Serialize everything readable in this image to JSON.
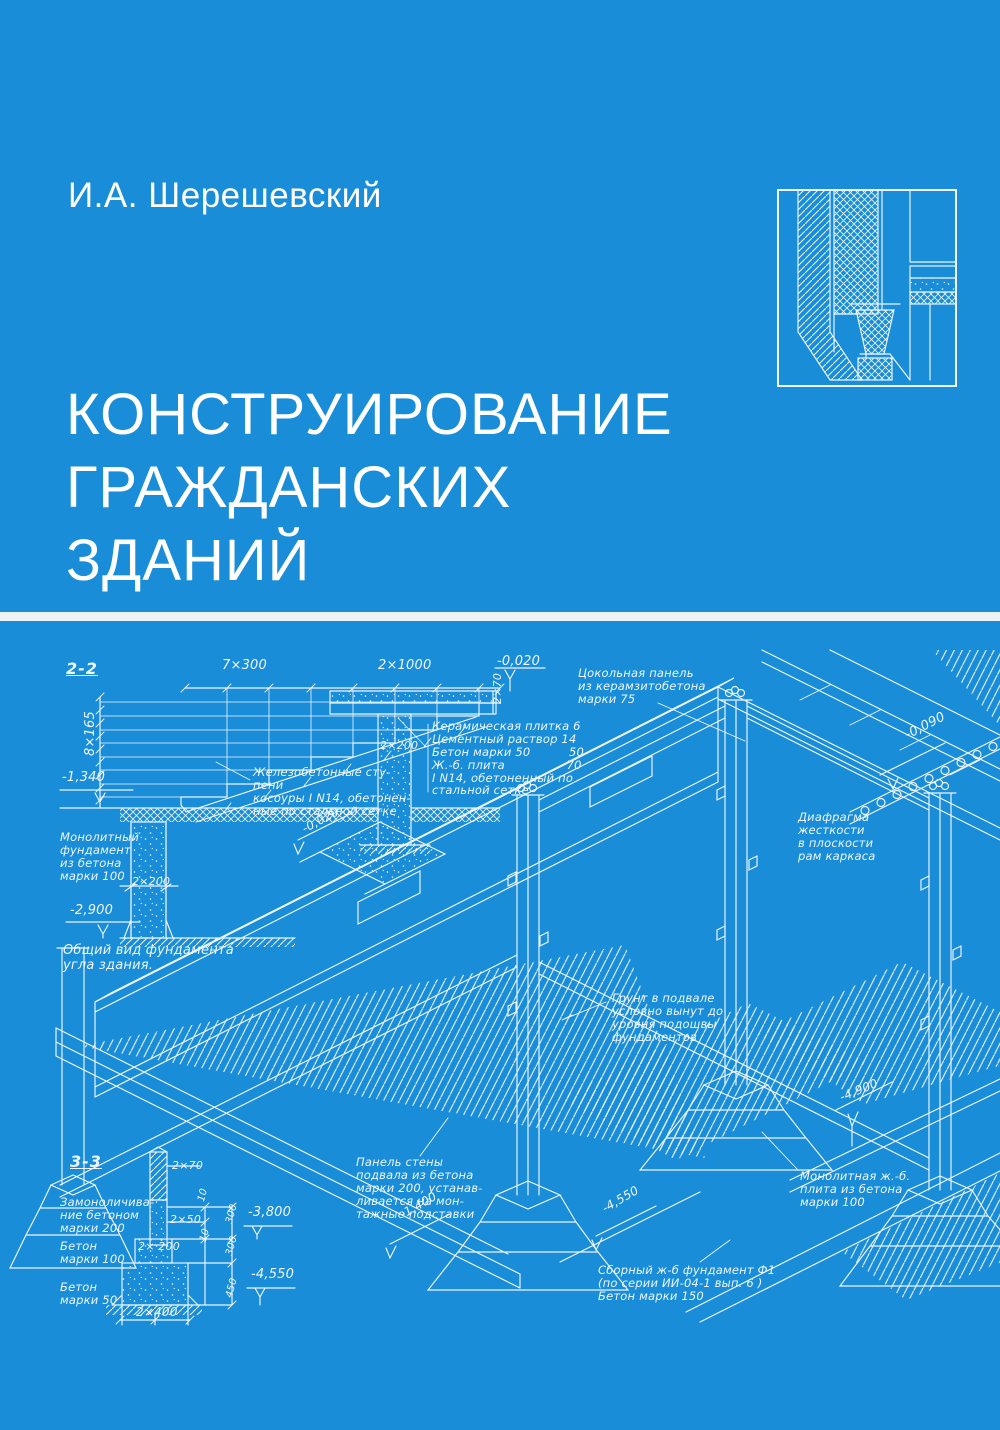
{
  "cover": {
    "author": "И.А. Шерешевский",
    "title_lines": [
      "КОНСТРУИРОВАНИЕ",
      "ГРАЖДАНСКИХ",
      "ЗДАНИЙ"
    ],
    "colors": {
      "background": "#1a8dd8",
      "ink": "#eef6fb",
      "title": "#ffffff",
      "divider": "#eef3f6"
    }
  },
  "drawing": {
    "labels": [
      {
        "text": "2-2",
        "x": 66,
        "y": 660,
        "size": 16,
        "u": true
      },
      {
        "text": "7×300",
        "x": 222,
        "y": 659,
        "size": 13
      },
      {
        "text": "2×1000",
        "x": 378,
        "y": 659,
        "size": 13
      },
      {
        "text": "-0,020",
        "x": 497,
        "y": 655,
        "size": 13
      },
      {
        "text": "8×165",
        "x": 84,
        "y": 756,
        "size": 13,
        "rot": -90
      },
      {
        "text": "2×70",
        "x": 492,
        "y": 704,
        "size": 11,
        "rot": -90
      },
      {
        "text": "2×200",
        "x": 380,
        "y": 740,
        "size": 11
      },
      {
        "text": "Керамическая плитка 6\nЦементный раствор 14\nБетон марки 50          50\nЖ.-б. плита                70\nI N14, обетоненный по\nстальной сетке",
        "x": 432,
        "y": 720,
        "size": 11.5
      },
      {
        "text": "Цокольная панель\nиз керамзитобетона\nмарки 75",
        "x": 578,
        "y": 667,
        "size": 11.5
      },
      {
        "text": "-0,090",
        "x": 903,
        "y": 730,
        "size": 13,
        "rot": -27
      },
      {
        "text": "Железобетонные сту-\nпени\nкосоуры I N14, обетонен-\nные по стальной сетке",
        "x": 253,
        "y": 766,
        "size": 11.5
      },
      {
        "text": "-1,340",
        "x": 62,
        "y": 771,
        "size": 13
      },
      {
        "text": "Монолитный\nфундамент\nиз бетона\nмарки 100",
        "x": 60,
        "y": 831,
        "size": 11.5
      },
      {
        "text": "2×200",
        "x": 132,
        "y": 876,
        "size": 11
      },
      {
        "text": "-2,900",
        "x": 70,
        "y": 904,
        "size": 13
      },
      {
        "text": "Общий вид фундамента\nугла здания.",
        "x": 63,
        "y": 944,
        "size": 13
      },
      {
        "text": "Диафрагма\nжесткости\nв плоскости\nрам каркаса",
        "x": 798,
        "y": 811,
        "size": 11.5
      },
      {
        "text": "Грунт в подвале\nусловно вынут до\nуровня подошвы\nфундаментов",
        "x": 612,
        "y": 992,
        "size": 11.5
      },
      {
        "text": "-0,020",
        "x": 300,
        "y": 824,
        "size": 12,
        "rot": -28
      },
      {
        "text": "3-3",
        "x": 70,
        "y": 1153,
        "size": 16,
        "u": true
      },
      {
        "text": "2×70",
        "x": 172,
        "y": 1160,
        "size": 11
      },
      {
        "text": "Замоноличива-\nние бетоном\nмарки 200",
        "x": 60,
        "y": 1196,
        "size": 11.5
      },
      {
        "text": "2×50",
        "x": 170,
        "y": 1214,
        "size": 11
      },
      {
        "text": "10",
        "x": 196,
        "y": 1200,
        "size": 10,
        "rot": -75
      },
      {
        "text": "10",
        "x": 198,
        "y": 1240,
        "size": 10,
        "rot": -75
      },
      {
        "text": "300",
        "x": 224,
        "y": 1222,
        "size": 10,
        "rot": -75
      },
      {
        "text": "300",
        "x": 224,
        "y": 1254,
        "size": 10,
        "rot": -75
      },
      {
        "text": "450",
        "x": 224,
        "y": 1296,
        "size": 10,
        "rot": -75
      },
      {
        "text": "-3,800",
        "x": 248,
        "y": 1206,
        "size": 13
      },
      {
        "text": "Бетон\nмарки 100",
        "x": 60,
        "y": 1240,
        "size": 11.5
      },
      {
        "text": "2× 200",
        "x": 138,
        "y": 1241,
        "size": 11
      },
      {
        "text": "-4,550",
        "x": 251,
        "y": 1268,
        "size": 13
      },
      {
        "text": "Бетон\nмарки 50",
        "x": 60,
        "y": 1281,
        "size": 11.5
      },
      {
        "text": "2×400",
        "x": 136,
        "y": 1306,
        "size": 12
      },
      {
        "text": "Панель стены\nподвала из бетона\nмарки 200, устанав-\nливается на мон-\nтажные подставки",
        "x": 356,
        "y": 1156,
        "size": 11.5
      },
      {
        "text": "-1,400",
        "x": 398,
        "y": 1210,
        "size": 12,
        "rot": -30
      },
      {
        "text": "-4,550",
        "x": 600,
        "y": 1204,
        "size": 12,
        "rot": -30
      },
      {
        "text": "Сборный ж-б фундамент Ф1\n(по серии ИИ-04-1 вып. 6 )\nБетон марки 150",
        "x": 598,
        "y": 1264,
        "size": 11.5
      },
      {
        "text": "-4,900",
        "x": 838,
        "y": 1092,
        "size": 12,
        "rot": -22
      },
      {
        "text": "Монолитная ж.-б.\nплита из бетона\nмарки 100",
        "x": 800,
        "y": 1170,
        "size": 11.5
      }
    ]
  }
}
